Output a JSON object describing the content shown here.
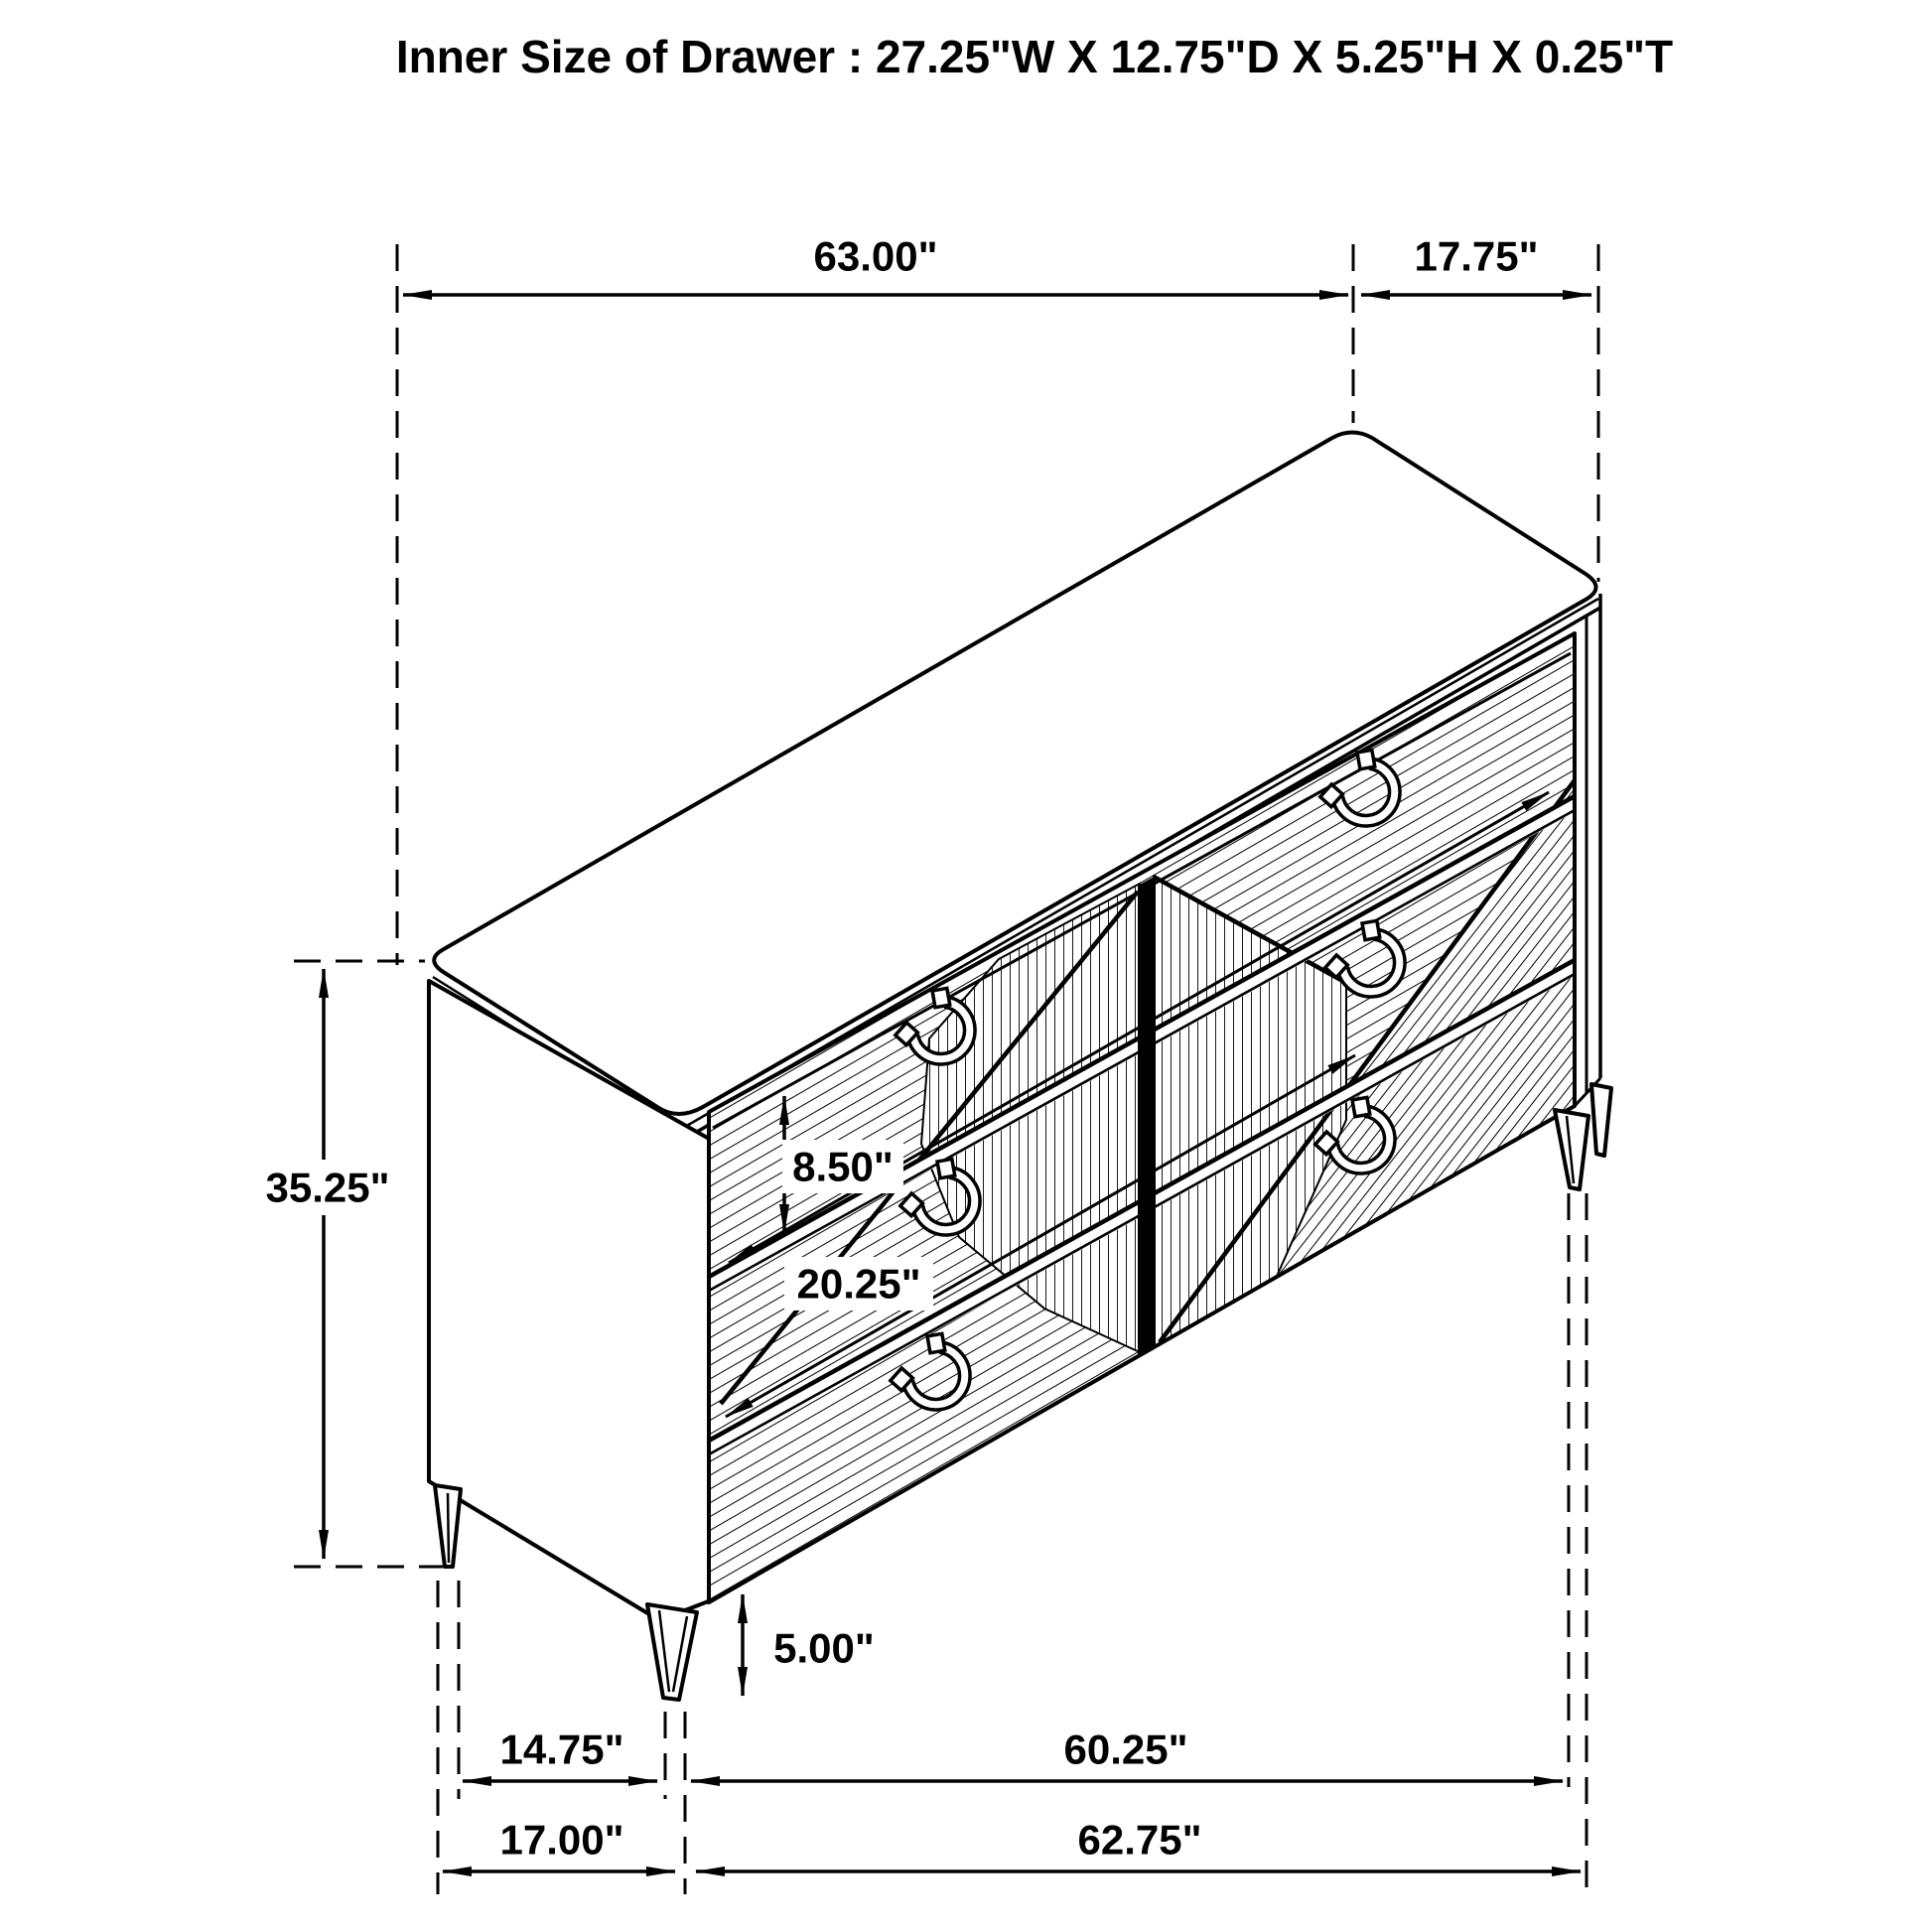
{
  "title": "Inner Size of Drawer : 27.25\"W X 12.75\"D X 5.25\"H X 0.25\"T",
  "colors": {
    "line": "#000000",
    "background": "#ffffff"
  },
  "dims": {
    "top_width": "63.00\"",
    "top_depth": "17.75\"",
    "overall_height": "35.25\"",
    "drawer_front_height": "8.50\"",
    "drawer_inner_depth": "20.25\"",
    "leg_height": "5.00\"",
    "front_leg_inset": "14.75\"",
    "leg_span_width": "60.25\"",
    "base_depth": "17.00\"",
    "base_width": "62.75\""
  }
}
